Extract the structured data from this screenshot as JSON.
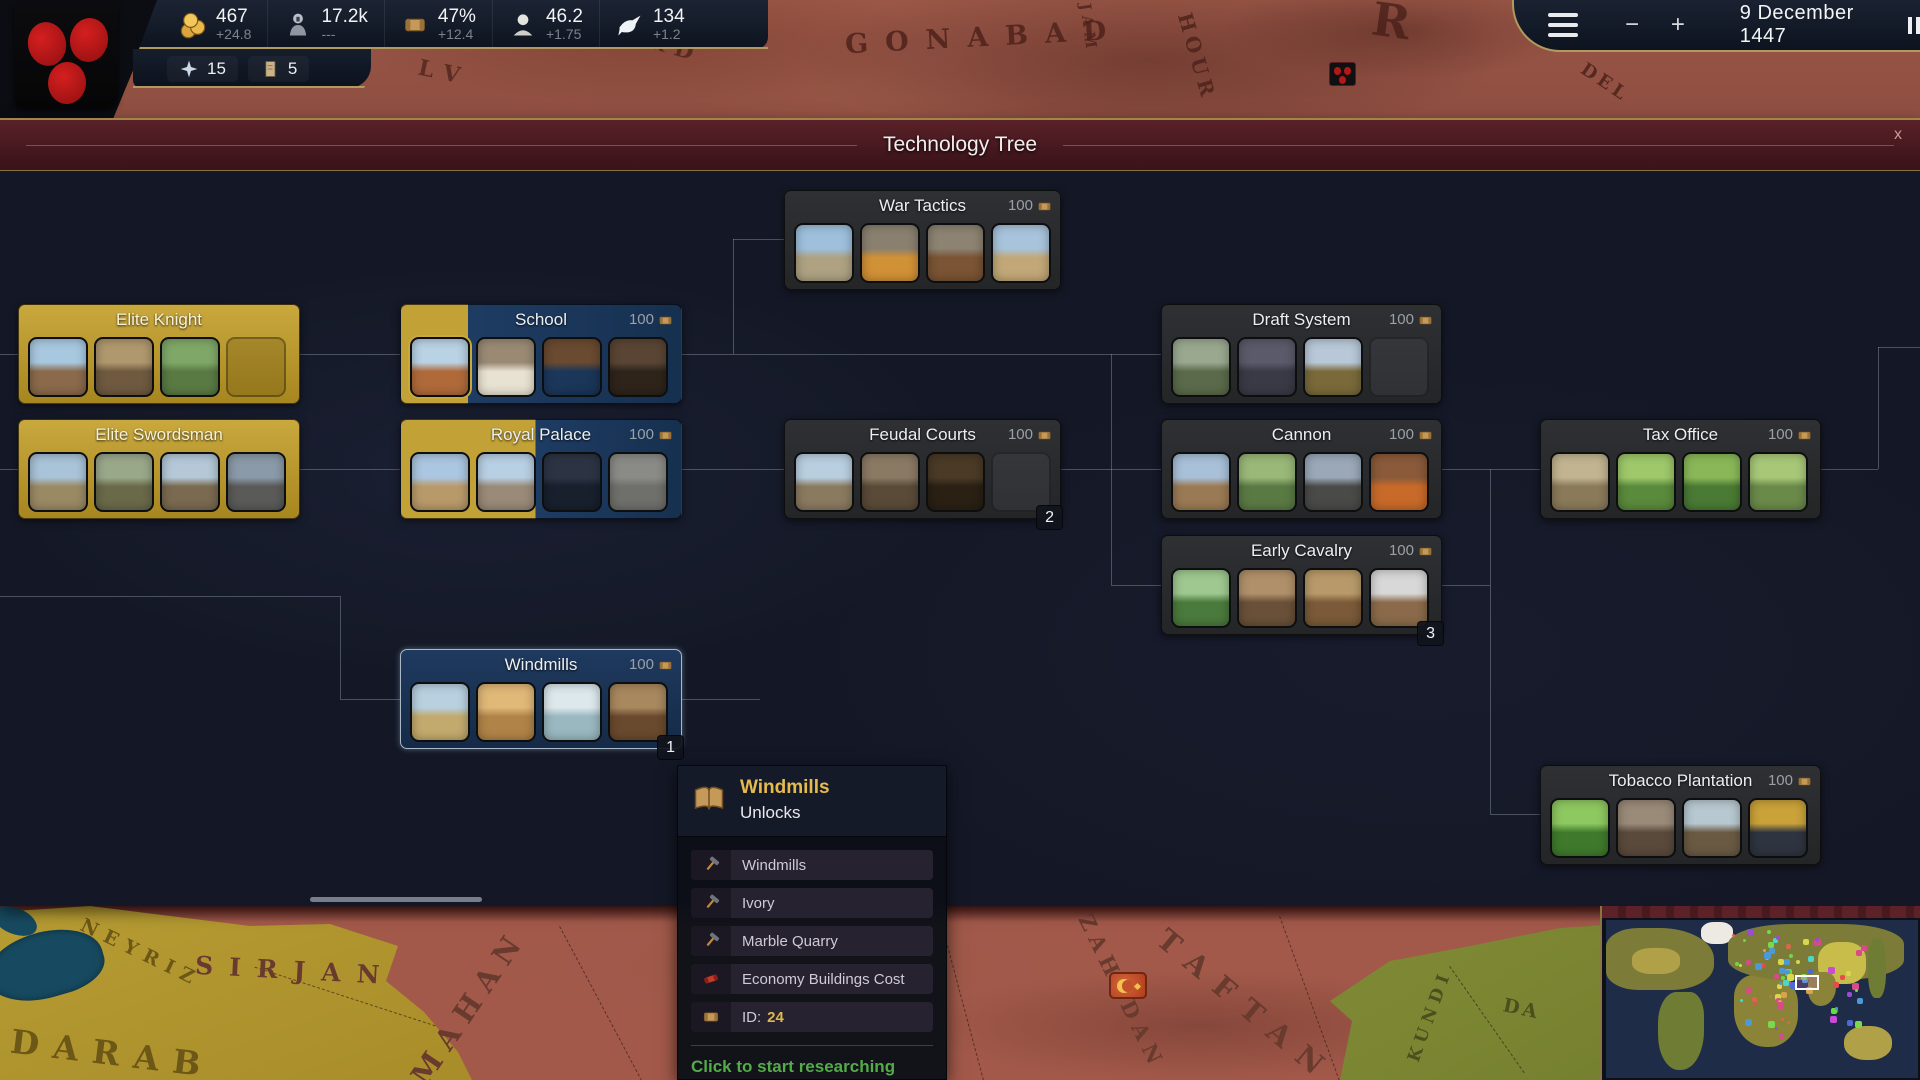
{
  "top_bar": {
    "resources": [
      {
        "id": "gold",
        "icon": "coins-icon",
        "value": "467",
        "delta": "+24.8"
      },
      {
        "id": "manpower",
        "icon": "soldier-icon",
        "value": "17.2k",
        "delta": "---"
      },
      {
        "id": "research",
        "icon": "scroll-icon",
        "value": "47%",
        "delta": "+12.4"
      },
      {
        "id": "culture",
        "icon": "bust-icon",
        "value": "46.2",
        "delta": "+1.75"
      },
      {
        "id": "diplomacy",
        "icon": "dove-icon",
        "value": "134",
        "delta": "+1.2"
      }
    ],
    "sub_badges": [
      {
        "id": "prestige",
        "icon": "star-icon",
        "value": "15"
      },
      {
        "id": "papers",
        "icon": "paper-icon",
        "value": "5"
      }
    ],
    "date": "9 December 1447"
  },
  "panel": {
    "title": "Technology Tree",
    "close_label": "x"
  },
  "nodes": [
    {
      "id": "war-tactics",
      "title": "War Tactics",
      "cost": "100",
      "state": "locked",
      "thumbs": [
        "palace-courtyard",
        "trumpet",
        "whip",
        "construction-site"
      ]
    },
    {
      "id": "elite-knight",
      "title": "Elite Knight",
      "state": "researched",
      "ghost": true,
      "thumbs": [
        "medieval-town",
        "knight-charge",
        "knight-gallop"
      ]
    },
    {
      "id": "school",
      "title": "School",
      "cost": "100",
      "state": "progress",
      "progress": 24,
      "thumbs": [
        "school-building",
        "mill-interior",
        "books",
        "scholars"
      ]
    },
    {
      "id": "elite-swordsman",
      "title": "Elite Swordsman",
      "state": "researched",
      "thumbs": [
        "castle-walls",
        "soldier-band",
        "duel",
        "armored-host"
      ]
    },
    {
      "id": "royal-palace",
      "title": "Royal Palace",
      "cost": "100",
      "state": "progress",
      "progress": 48,
      "thumbs": [
        "palace-front",
        "grand-manor",
        "night-tavern",
        "sword"
      ]
    },
    {
      "id": "feudal-courts",
      "title": "Feudal Courts",
      "cost": "100",
      "state": "locked",
      "badge": "2",
      "ghost": true,
      "thumbs": [
        "keep-tower",
        "court-gate",
        "coin-sack"
      ]
    },
    {
      "id": "draft-system",
      "title": "Draft System",
      "cost": "100",
      "state": "locked",
      "ghost": true,
      "thumbs": [
        "musketeers",
        "dark-courtyard",
        "battle-plain"
      ]
    },
    {
      "id": "cannon",
      "title": "Cannon",
      "cost": "100",
      "state": "locked",
      "thumbs": [
        "town-square",
        "farmland",
        "field-cannon",
        "burning-fort"
      ]
    },
    {
      "id": "early-cavalry",
      "title": "Early Cavalry",
      "cost": "100",
      "state": "locked",
      "badge": "3",
      "thumbs": [
        "vineyard",
        "timber-inn",
        "cavalry-charge",
        "white-knight"
      ]
    },
    {
      "id": "tax-office",
      "title": "Tax Office",
      "cost": "100",
      "state": "locked",
      "thumbs": [
        "tax-hall",
        "green-field",
        "crop-rows",
        "manor-grounds"
      ]
    },
    {
      "id": "windmills",
      "title": "Windmills",
      "cost": "100",
      "state": "selected",
      "badge": "1",
      "thumbs": [
        "windmill-plain",
        "elephant-savanna",
        "marble-quarry",
        "timber-town"
      ]
    },
    {
      "id": "tobacco-plantation",
      "title": "Tobacco Plantation",
      "cost": "100",
      "state": "locked",
      "thumbs": [
        "tobacco-field",
        "castle-gathering",
        "plantation-vale",
        "gold-emblem"
      ]
    }
  ],
  "tooltip": {
    "icon": "book-icon",
    "title": "Windmills",
    "subtitle": "Unlocks",
    "rows": [
      {
        "icon": "hammer-icon",
        "label": "Windmills"
      },
      {
        "icon": "hammer-icon",
        "label": "Ivory"
      },
      {
        "icon": "hammer-icon",
        "label": "Marble Quarry"
      },
      {
        "icon": "red-scroll-icon",
        "label": "Economy Buildings Cost"
      },
      {
        "icon": "scroll-icon",
        "label": "ID:",
        "value": "24"
      }
    ],
    "footer": "Click to start researching"
  },
  "map": {
    "top_labels": [
      {
        "id": "gonabad",
        "text": "GONABAD"
      },
      {
        "id": "ferd",
        "text": "FERD"
      },
      {
        "id": "jam",
        "text": "JAM"
      },
      {
        "id": "hour",
        "text": "HOUR"
      },
      {
        "id": "lv",
        "text": "LV"
      },
      {
        "id": "del",
        "text": "DEL"
      },
      {
        "id": "r",
        "text": "R"
      }
    ],
    "bottom_labels": [
      {
        "id": "neyriz",
        "text": "NEYRIZ"
      },
      {
        "id": "sirjan",
        "text": "SIRJAN"
      },
      {
        "id": "darab",
        "text": "DARAB"
      },
      {
        "id": "mahan",
        "text": "MAHAN"
      },
      {
        "id": "zahedan",
        "text": "ZAHEDAN"
      },
      {
        "id": "taftan",
        "text": "TAFTAN"
      },
      {
        "id": "kundi",
        "text": "KUNDI"
      },
      {
        "id": "da",
        "text": "DA"
      }
    ]
  },
  "colors": {
    "researched_gold": "#c9a93e",
    "progress_gold": "#c2a136",
    "available_blue": "#1e3c63",
    "locked_gray": "#2b2d2f",
    "accent_gold_trim": "#b09a5e",
    "footer_green": "#53ab49",
    "tooltip_title_gold": "#e5bb4e"
  }
}
